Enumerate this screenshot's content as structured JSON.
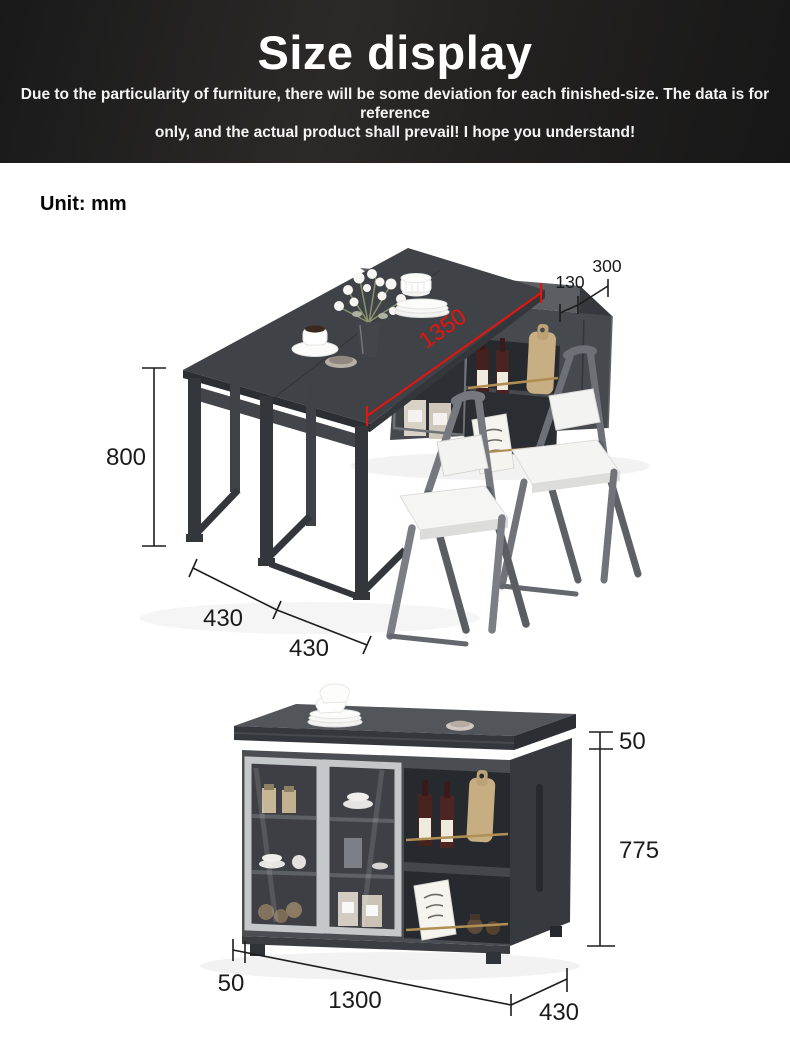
{
  "header": {
    "title": "Size display",
    "subtitle_line1": "Due to the particularity of furniture, there will be some deviation for each finished-size. The data is for reference",
    "subtitle_line2": "only, and the actual product shall prevail! I hope you understand!"
  },
  "unit_label": "Unit: mm",
  "table_diagram": {
    "length": "1350",
    "height": "800",
    "fold_depth_front": "430",
    "fold_depth_back": "430",
    "cabinet_top_gap": "130",
    "cabinet_depth": "300"
  },
  "sideboard_diagram": {
    "top_thickness": "50",
    "body_height": "775",
    "base_inset": "50",
    "width": "1300",
    "depth": "430"
  },
  "colors": {
    "dimension_red": "#e8140c",
    "dimension_black": "#1d1d1d",
    "header_background": "#232120",
    "furniture_dark": "#3f4247",
    "furniture_gray": "#4a4d52",
    "door_frame_gray": "#c5c8cb",
    "brass_rail": "#b08f55"
  }
}
